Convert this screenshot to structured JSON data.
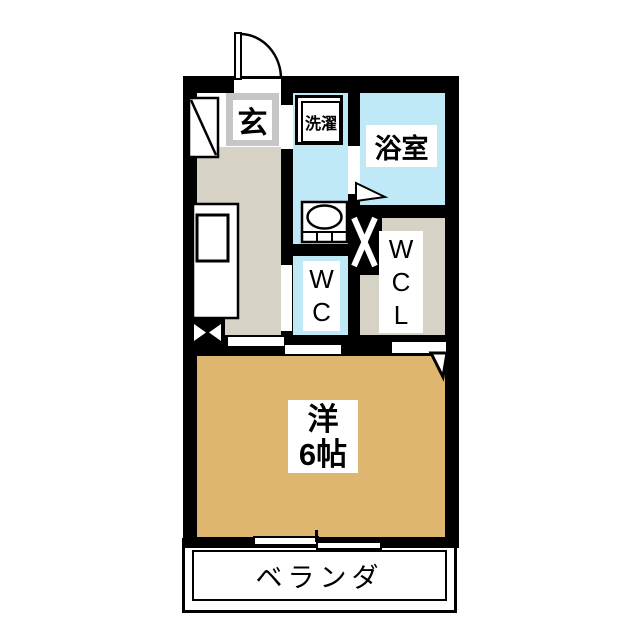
{
  "floorplan": {
    "title": "apartment-floor-plan",
    "rooms": {
      "entrance": {
        "label": "玄"
      },
      "laundry": {
        "label": "洗濯"
      },
      "bathroom": {
        "label": "浴室"
      },
      "toilet": {
        "label": "WC"
      },
      "walk_in_closet": {
        "label": "WCL"
      },
      "main_room": {
        "label_line1": "洋",
        "label_line2": "6帖"
      },
      "veranda": {
        "label": "ベランダ"
      }
    },
    "symbols": [
      "entrance-door-swing-icon",
      "shoe-cabinet-icon",
      "kitchen-sink-icon",
      "pipe-space-icon",
      "washbasin-icon",
      "duct-icon",
      "bathroom-door-arrow-icon",
      "room-door-arrow-icon",
      "sliding-door-icon",
      "sliding-window-icon"
    ],
    "colors": {
      "wall": "#000000",
      "wet_area_floor": "#bfe9f6",
      "hallway_floor": "#d6d2c5",
      "closet_floor": "#d6d2c5",
      "main_room_floor": "#dfb66f",
      "entrance_label_border": "#c6c6c6",
      "background": "#ffffff"
    }
  }
}
